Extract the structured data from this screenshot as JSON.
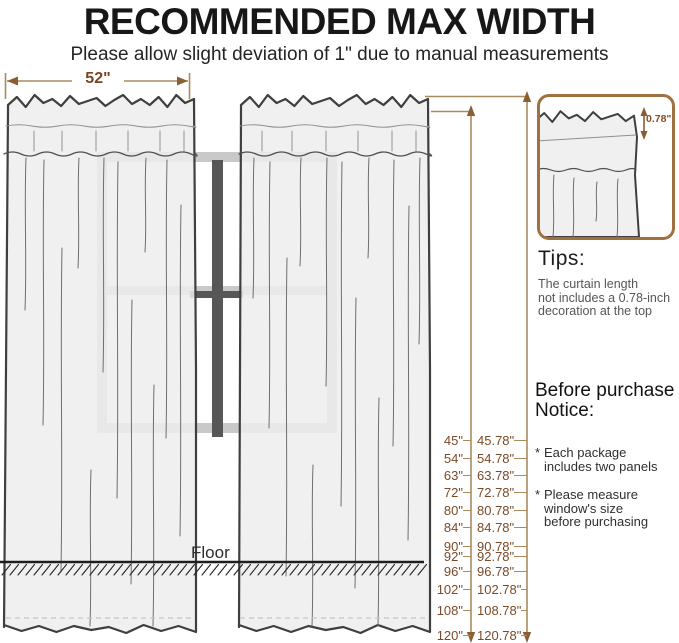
{
  "header": {
    "title": "RECOMMENDED MAX WIDTH",
    "subtitle": "Please allow slight deviation of 1\" due to manual measurements"
  },
  "diagram": {
    "width_label": "52\"",
    "floor_label": "Floor",
    "inset_label": "0.78\"",
    "measurements": [
      {
        "length": "45\"",
        "total": "45.78\""
      },
      {
        "length": "54\"",
        "total": "54.78\""
      },
      {
        "length": "63\"",
        "total": "63.78\""
      },
      {
        "length": "72\"",
        "total": "72.78\""
      },
      {
        "length": "80\"",
        "total": "80.78\""
      },
      {
        "length": "84\"",
        "total": "84.78\""
      },
      {
        "length": "90\"",
        "total": "90.78\""
      },
      {
        "length": "92\"",
        "total": "92.78\""
      },
      {
        "length": "96\"",
        "total": "96.78\""
      },
      {
        "length": "102\"",
        "total": "102.78\""
      },
      {
        "length": "108\"",
        "total": "108.78\""
      },
      {
        "length": "120\"",
        "total": "120.78\""
      }
    ]
  },
  "tips": {
    "heading": "Tips:",
    "lines": [
      "The curtain length",
      "not includes a 0.78-inch",
      "decoration at the top"
    ]
  },
  "notice": {
    "heading": [
      "Before purchase",
      "Notice:"
    ],
    "bullets": [
      {
        "marker": "*",
        "lines": [
          "Each package",
          "includes two panels"
        ]
      },
      {
        "marker": "*",
        "lines": [
          "Please measure",
          "window's size",
          "before purchasing"
        ]
      }
    ]
  },
  "colors": {
    "accent_brown": "#7c4a28",
    "line_tan": "#a98a5e",
    "inset_border": "#a0713f",
    "window_light": "#c9c9c9",
    "window_dark": "#575757"
  }
}
